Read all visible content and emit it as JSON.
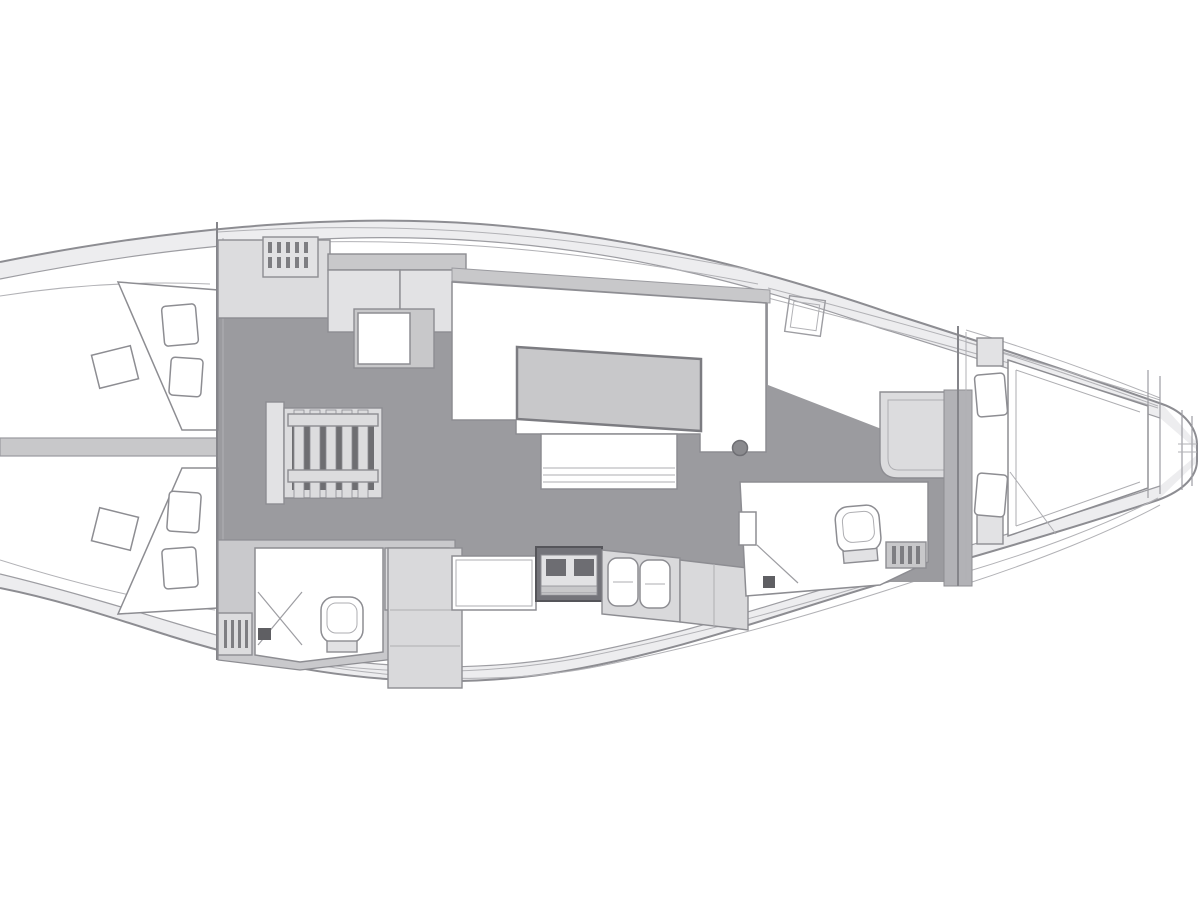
{
  "document": {
    "kind": "sailing-yacht-interior-floor-plan",
    "view": "top-down deck plan drawing",
    "orientation": "stern at left edge (cropped), bow at right",
    "visible_text": ""
  },
  "palette": {
    "background": "#ffffff",
    "deck_band": "#ededef",
    "floor_dark": "#9b9b9f",
    "furniture_light": "#dcdcde",
    "furniture_panel": "#e2e2e4",
    "furniture_mid": "#c8c8ca",
    "counter": "#d9d9db",
    "wall_mid": "#b2b2b6",
    "surround": "#c9c9cc",
    "stove_frame": "#74747a",
    "burner_dark": "#6d6d72",
    "step_well": "#6e6e72",
    "slat_dark": "#7e7e82",
    "accent_dark": "#5f5f63",
    "outline": "#8d8d92",
    "white": "#ffffff"
  },
  "legend": {
    "areas": [
      {
        "id": "aft-cabin-port",
        "desc": "aft double cabin, port, angled berth with two pillows"
      },
      {
        "id": "aft-cabin-starboard",
        "desc": "aft double cabin, starboard, angled berth with two pillows"
      },
      {
        "id": "aft-head",
        "desc": "aft bathroom with toilet, shower stall and slatted seat"
      },
      {
        "id": "companionway",
        "desc": "companionway steps with slatted treads"
      },
      {
        "id": "salon",
        "desc": "U-shaped settee, saloon table, centerline bench"
      },
      {
        "id": "galley",
        "desc": "worktop, two-burner stove, double sink, counters"
      },
      {
        "id": "forward-head",
        "desc": "forward bathroom with toilet, vanity and door"
      },
      {
        "id": "wardrobe",
        "desc": "wardrobe / wet locker beside forward head"
      },
      {
        "id": "forward-cabin",
        "desc": "bow cabin with tapered double berth, pillows, shelves"
      },
      {
        "id": "anchor-locker",
        "desc": "anchor locker at bow tip"
      }
    ]
  }
}
